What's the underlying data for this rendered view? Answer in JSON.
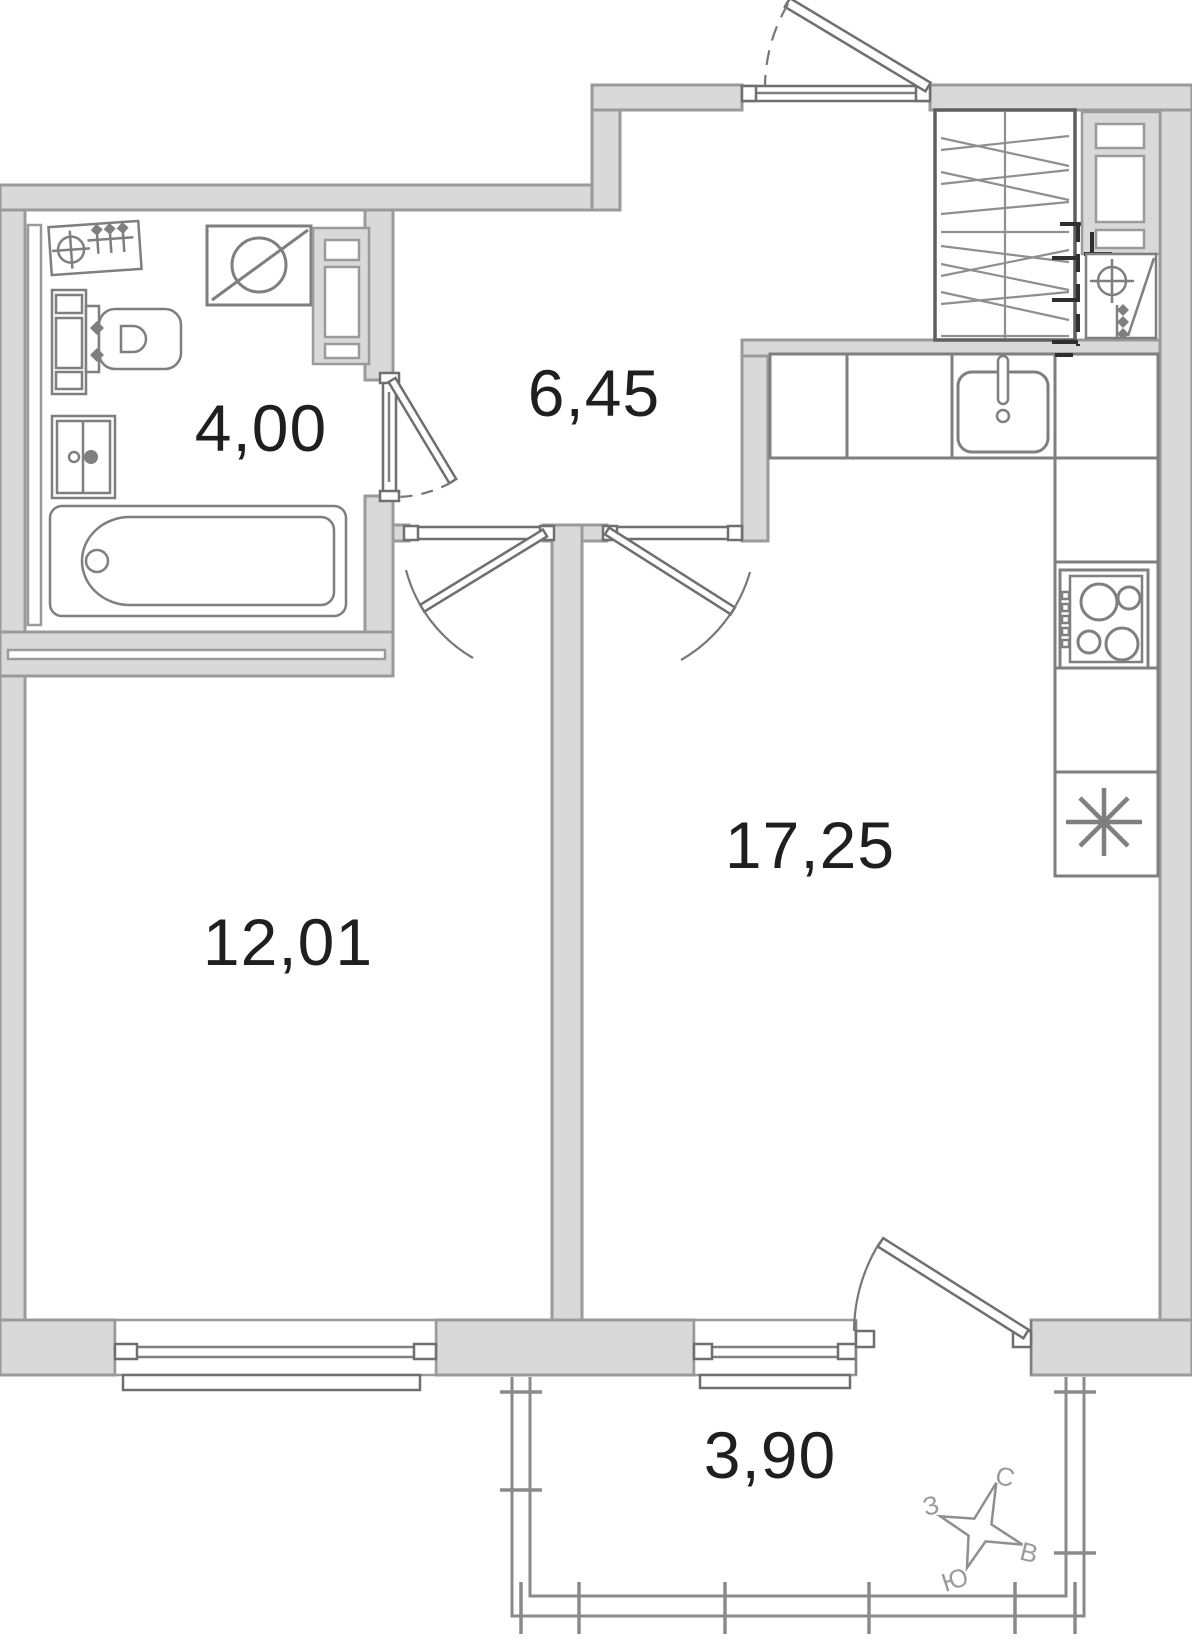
{
  "plan": {
    "rooms": {
      "bathroom": {
        "area": "4,00"
      },
      "hallway": {
        "area": "6,45"
      },
      "bedroom": {
        "area": "12,01"
      },
      "kitchen_living": {
        "area": "17,25"
      },
      "balcony": {
        "area": "3,90"
      }
    },
    "compass": {
      "north": "С",
      "east": "В",
      "south": "Ю",
      "west": "З"
    },
    "colors": {
      "wall_fill": "#d9d9d9",
      "wall_stroke": "#9a9a9a",
      "fixture_stroke": "#7f7f7f",
      "furniture_stroke": "#5f5f5f",
      "marker_dark": "#2f2f2f",
      "label_text": "#1f1f1f",
      "compass_text": "#9a9a9a",
      "background": "#ffffff"
    }
  }
}
